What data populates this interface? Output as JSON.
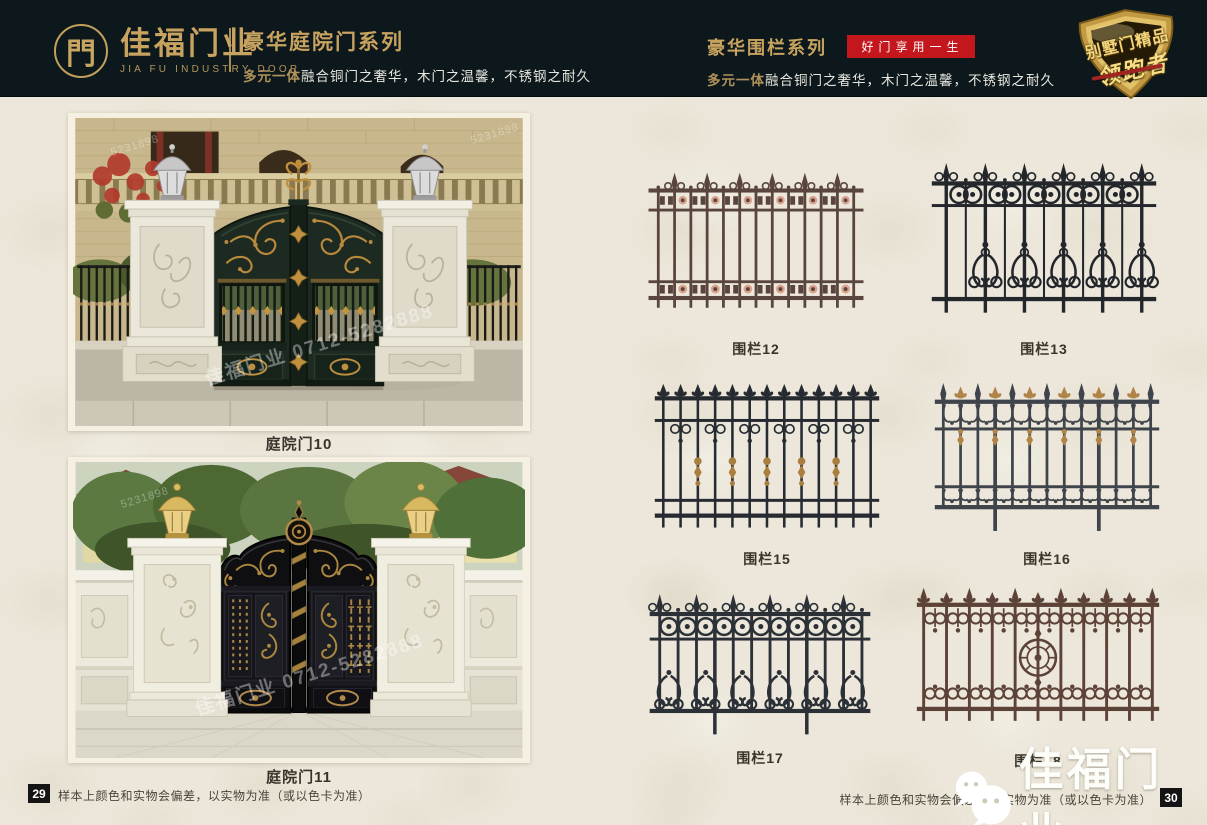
{
  "header": {
    "colors": {
      "bg": "#0d181c",
      "gold": "#c8a35f",
      "red": "#c4161d"
    },
    "logo": {
      "glyph": "門",
      "name": "佳福门业",
      "name_en": "JIA FU INDUSTRY DOOR"
    },
    "left_series": {
      "title": "豪华庭院门系列",
      "subtitle_lead": "多元一体",
      "subtitle_rest": "融合铜门之奢华，木门之温馨，不锈钢之耐久"
    },
    "right_series": {
      "title": "豪华围栏系列",
      "badge": "好门享用一生",
      "subtitle_lead": "多元一体",
      "subtitle_rest": "融合铜门之奢华，木门之温馨，不锈钢之耐久"
    },
    "shield": {
      "line1": "别墅门精品",
      "line2": "领跑者"
    }
  },
  "left_page": {
    "photos": [
      {
        "caption": "庭院门10"
      },
      {
        "caption": "庭院门11"
      }
    ],
    "watermark_text": "佳福门业 0712-5282888",
    "watermark_code": "5231898",
    "page_number": "29",
    "disclaimer": "样本上颜色和实物会偏差，以实物为准（或以色卡为准）"
  },
  "right_page": {
    "fences": [
      {
        "caption": "围栏12",
        "art": {
          "variant": "v12",
          "color": "#5a453e",
          "accent": "#d9a28c"
        }
      },
      {
        "caption": "围栏13",
        "art": {
          "variant": "v13",
          "color": "#23262b",
          "accent": "#3a3e44"
        }
      },
      {
        "caption": "围栏15",
        "art": {
          "variant": "v15",
          "color": "#262b31",
          "accent": "#a97f3f"
        }
      },
      {
        "caption": "围栏16",
        "art": {
          "variant": "v16",
          "color": "#3f444b",
          "accent": "#b08448"
        }
      },
      {
        "caption": "围栏17",
        "art": {
          "variant": "v17",
          "color": "#2c3138",
          "accent": "#8a7456"
        }
      },
      {
        "caption": "围栏18",
        "art": {
          "variant": "v18",
          "color": "#5d4238",
          "accent": "#7a584a"
        }
      }
    ],
    "page_number": "30",
    "disclaimer": "样本上颜色和实物会偏差，以实物为准（或以色卡为准）",
    "watermark_brand": "佳福门业"
  }
}
